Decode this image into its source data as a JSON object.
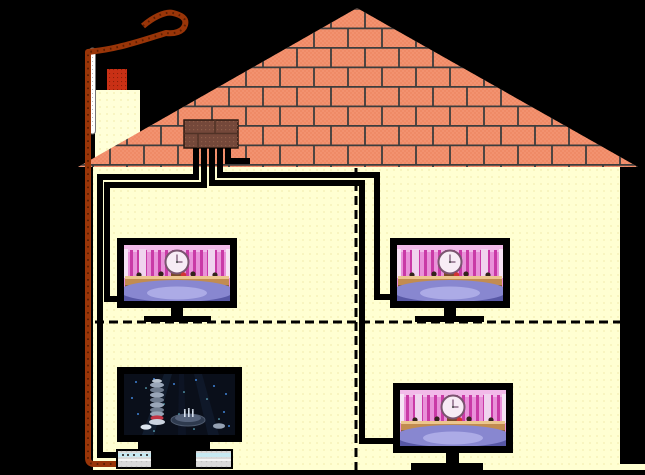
{
  "meta": {
    "description": "Pixel-art cross-section diagram of a two-storey house showing a rooftop aerial drop cable, a loft distribution amplifier and coaxial feeds to four television sets and a video recorder",
    "background": "#000000",
    "text_content": "none - diagram contains no text"
  },
  "palette": {
    "wall": "#FFFFD2",
    "roof": "#EF8A66",
    "roof_dot": "#F8A88B",
    "brick_line": "#3D3D3D",
    "chimney_body": "#FFFFD8",
    "chimney_pot": "#C93015",
    "mast": "#FFFFFF",
    "drop_cable": "#993508",
    "feed_cable": "#000000",
    "amplifier": "#74483A",
    "vcr_body": "#DADADA",
    "vcr_stripe": "#C7E9F2",
    "screen_gameshow_bg": "#E991D9",
    "screen_dark_bg": "#0A0F1A"
  },
  "house": {
    "storeys": 2,
    "rooms_shown": 4,
    "floor_divider": {
      "style": "dashed",
      "path": "M95,322 L620,322"
    },
    "room_divider": {
      "style": "dashed",
      "path": "M356,168 L356,470"
    },
    "ground_line": {
      "path": "M93,472 L645,472"
    }
  },
  "cables": {
    "drop": {
      "label": "aerial drop cable from overhead line down outside wall into video recorder",
      "color": "#993508",
      "path": "M143,26 C152,18 165,11 173,13 C181,15 187,18 185,25 C183,32 174,34 166,33 C150,38 132,44 118,47 C106,50 96,51 88,52 L88,458 Q88,464 94,464 L117,464"
    },
    "feeds": [
      {
        "label": "feed to video recorder, ground floor left",
        "path": "M196,148 L196,177 L100,177 L100,455 L117,455"
      },
      {
        "label": "feed to upper-left television",
        "path": "M204,148 L204,185 L107,185 L107,299 L117,299"
      },
      {
        "label": "feed to upper-right television",
        "path": "M220,148 L220,175 L377,175 L377,297 L390,297"
      },
      {
        "label": "feed to lower-right television",
        "path": "M212,148 L212,183 L362,183 L362,441 L393,441"
      },
      {
        "label": "spare stub in loft",
        "path": "M228,148 L228,161 L250,161"
      }
    ]
  },
  "devices": {
    "amplifier": {
      "label": "loft distribution amplifier on roof",
      "outputs": 5
    },
    "mast": {
      "label": "white wall mast beside chimney"
    },
    "chimney": {
      "label": "chimney with red pot"
    },
    "vcr": {
      "label": "video recorder under lower-left television"
    },
    "tvs": [
      {
        "label": "upper-left television",
        "screen": "gameshow"
      },
      {
        "label": "upper-right television",
        "screen": "gameshow"
      },
      {
        "label": "lower-right television",
        "screen": "gameshow"
      },
      {
        "label": "lower-left television",
        "screen": "dark-studio"
      }
    ]
  },
  "screens": {
    "gameshow": {
      "description": "pink game-show studio with large central clock, desks and blue floor",
      "bg": "#E991D9",
      "stripe": "#C93AA6",
      "clock_face": "#F7ECF5",
      "desk": "#C28C50",
      "floor": "#8887D0"
    },
    "dark_studio": {
      "description": "dark stage with grey spiral tower, scattered blue lights and centre platform",
      "bg": "#0A0F1A",
      "tower": "#9AA6B8",
      "accent": "#C23444"
    }
  }
}
